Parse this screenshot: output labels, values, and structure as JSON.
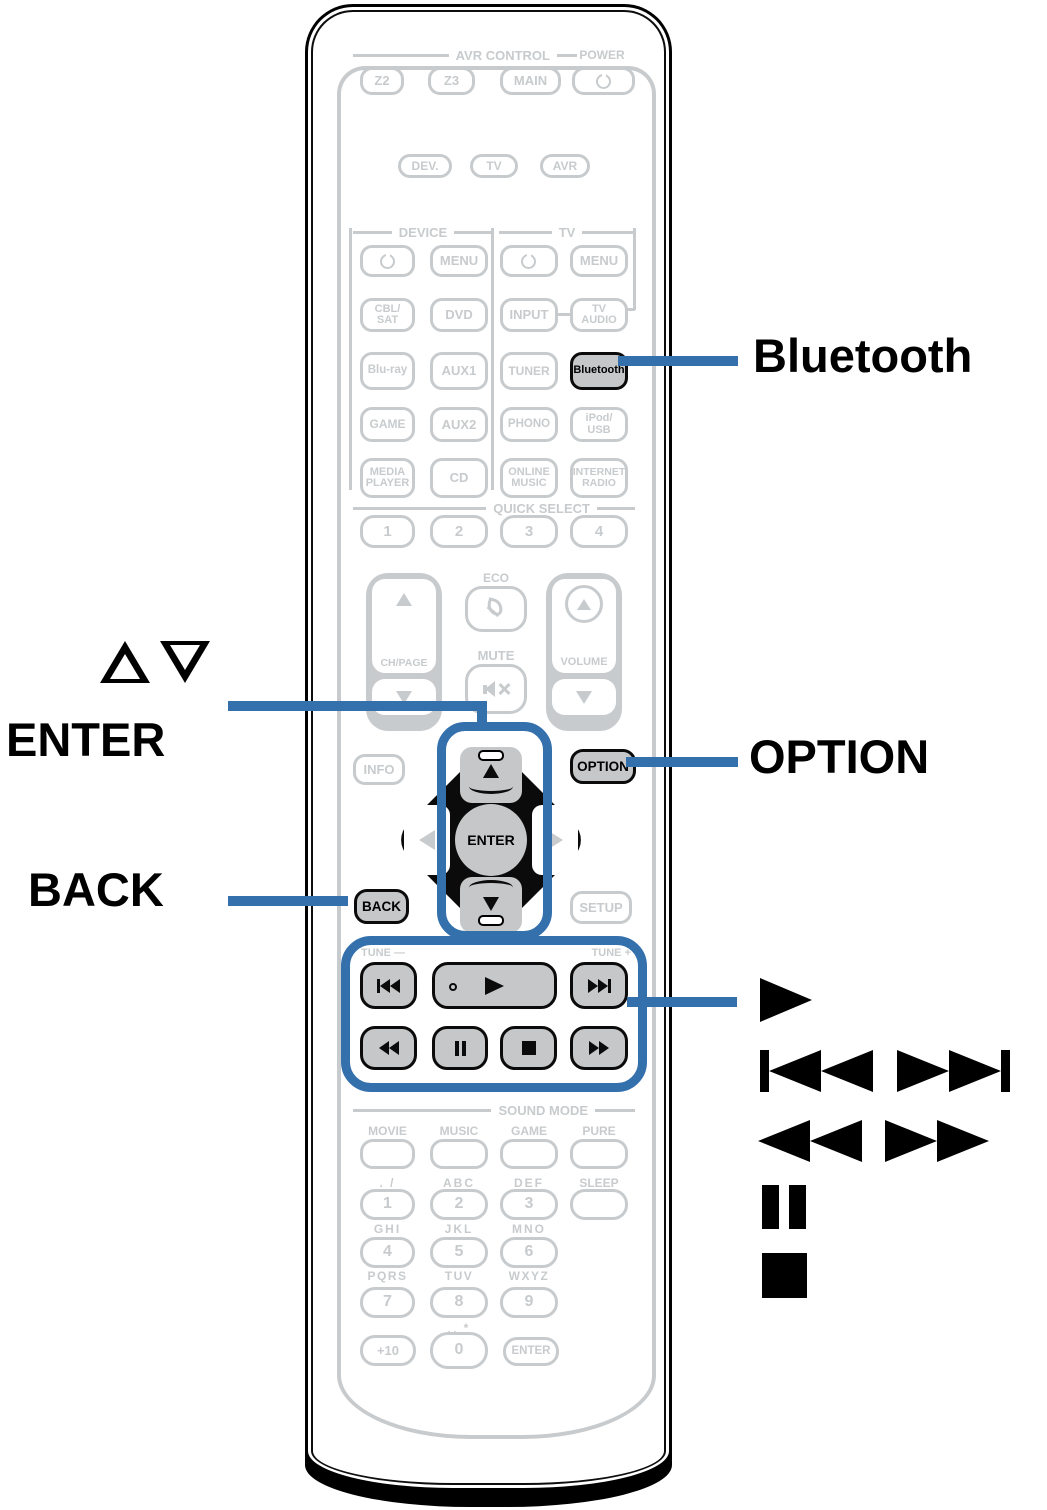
{
  "accent_blue": "#3470ac",
  "callouts": {
    "bluetooth": "Bluetooth",
    "cursor_updown": "△▽",
    "enter": "ENTER",
    "option": "OPTION",
    "back": "BACK"
  },
  "remote": {
    "avr_control": {
      "header": "AVR CONTROL",
      "power_header": "POWER",
      "z2": "Z2",
      "z3": "Z3",
      "main": "MAIN"
    },
    "modes": {
      "dev": "DEV.",
      "tv": "TV",
      "avr": "AVR"
    },
    "source": {
      "device_header": "DEVICE",
      "tv_header": "TV",
      "device_menu": "MENU",
      "tv_menu": "MENU",
      "cbl_sat": "CBL/\nSAT",
      "dvd": "DVD",
      "input": "INPUT",
      "tv_audio": "TV\nAUDIO",
      "blu_ray": "Blu-ray",
      "aux1": "AUX1",
      "tuner": "TUNER",
      "bluetooth": "Bluetooth",
      "game": "GAME",
      "aux2": "AUX2",
      "phono": "PHONO",
      "ipod_usb": "iPod/\nUSB",
      "media_player": "MEDIA\nPLAYER",
      "cd": "CD",
      "online_music": "ONLINE\nMUSIC",
      "internet_radio": "INTERNET\nRADIO"
    },
    "quick_select": {
      "header": "QUICK SELECT",
      "b1": "1",
      "b2": "2",
      "b3": "3",
      "b4": "4"
    },
    "center": {
      "eco": "ECO",
      "mute": "MUTE",
      "ch_page": "CH/PAGE",
      "volume": "VOLUME"
    },
    "nav": {
      "info": "INFO",
      "option": "OPTION",
      "enter": "ENTER",
      "back": "BACK",
      "setup": "SETUP"
    },
    "transport": {
      "tune_minus": "TUNE —",
      "tune_plus": "TUNE +"
    },
    "sound_mode": {
      "header": "SOUND MODE",
      "movie": "MOVIE",
      "music": "MUSIC",
      "game": "GAME",
      "pure": "PURE"
    },
    "keypad": {
      "row1_labels": {
        "c1": ". /",
        "c2": "ABC",
        "c3": "DEF",
        "c4": "SLEEP"
      },
      "d1": "1",
      "d2": "2",
      "d3": "3",
      "row2_labels": {
        "c1": "GHI",
        "c2": "JKL",
        "c3": "MNO"
      },
      "d4": "4",
      "d5": "5",
      "d6": "6",
      "row3_labels": {
        "c1": "PQRS",
        "c2": "TUV",
        "c3": "WXYZ"
      },
      "d7": "7",
      "d8": "8",
      "d9": "9",
      "zero_label": "␣ *",
      "plus10": "+10",
      "d0": "0",
      "enter": "ENTER"
    }
  }
}
